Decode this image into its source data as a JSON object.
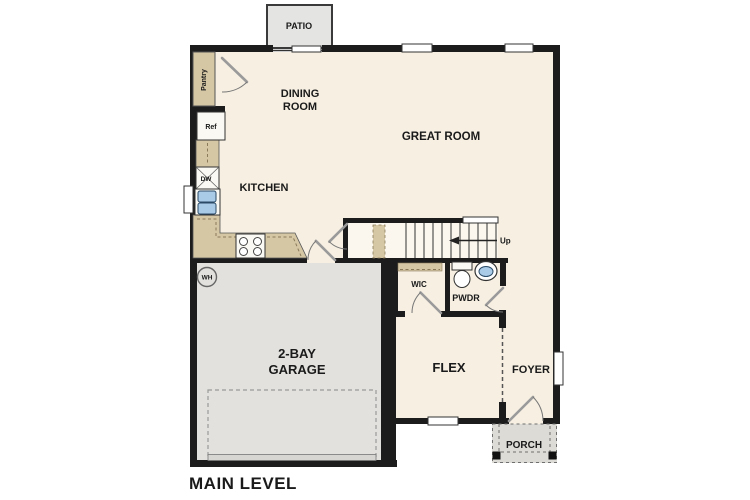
{
  "plan": {
    "title": "MAIN LEVEL",
    "rooms": {
      "patio": "PATIO",
      "dining_line1": "DINING",
      "dining_line2": "ROOM",
      "great_room": "GREAT ROOM",
      "kitchen": "KITCHEN",
      "garage_line1": "2-BAY",
      "garage_line2": "GARAGE",
      "wic": "WIC",
      "pwdr": "PWDR",
      "flex": "FLEX",
      "foyer": "FOYER",
      "porch": "PORCH"
    },
    "fixtures": {
      "pantry": "Pantry",
      "refrigerator": "Ref",
      "dishwasher": "DW",
      "water_heater": "WH",
      "stairs_direction": "Up"
    },
    "colors": {
      "floor": "#f6efe2",
      "stairs_floor": "#fbf7ee",
      "counter": "#d5c6a4",
      "garage_floor": "#e2e1dd",
      "patio": "#e4e4e2",
      "porch": "#dcdbd6",
      "wall": "#1c1c1c",
      "water": "#a9cbe8"
    }
  }
}
